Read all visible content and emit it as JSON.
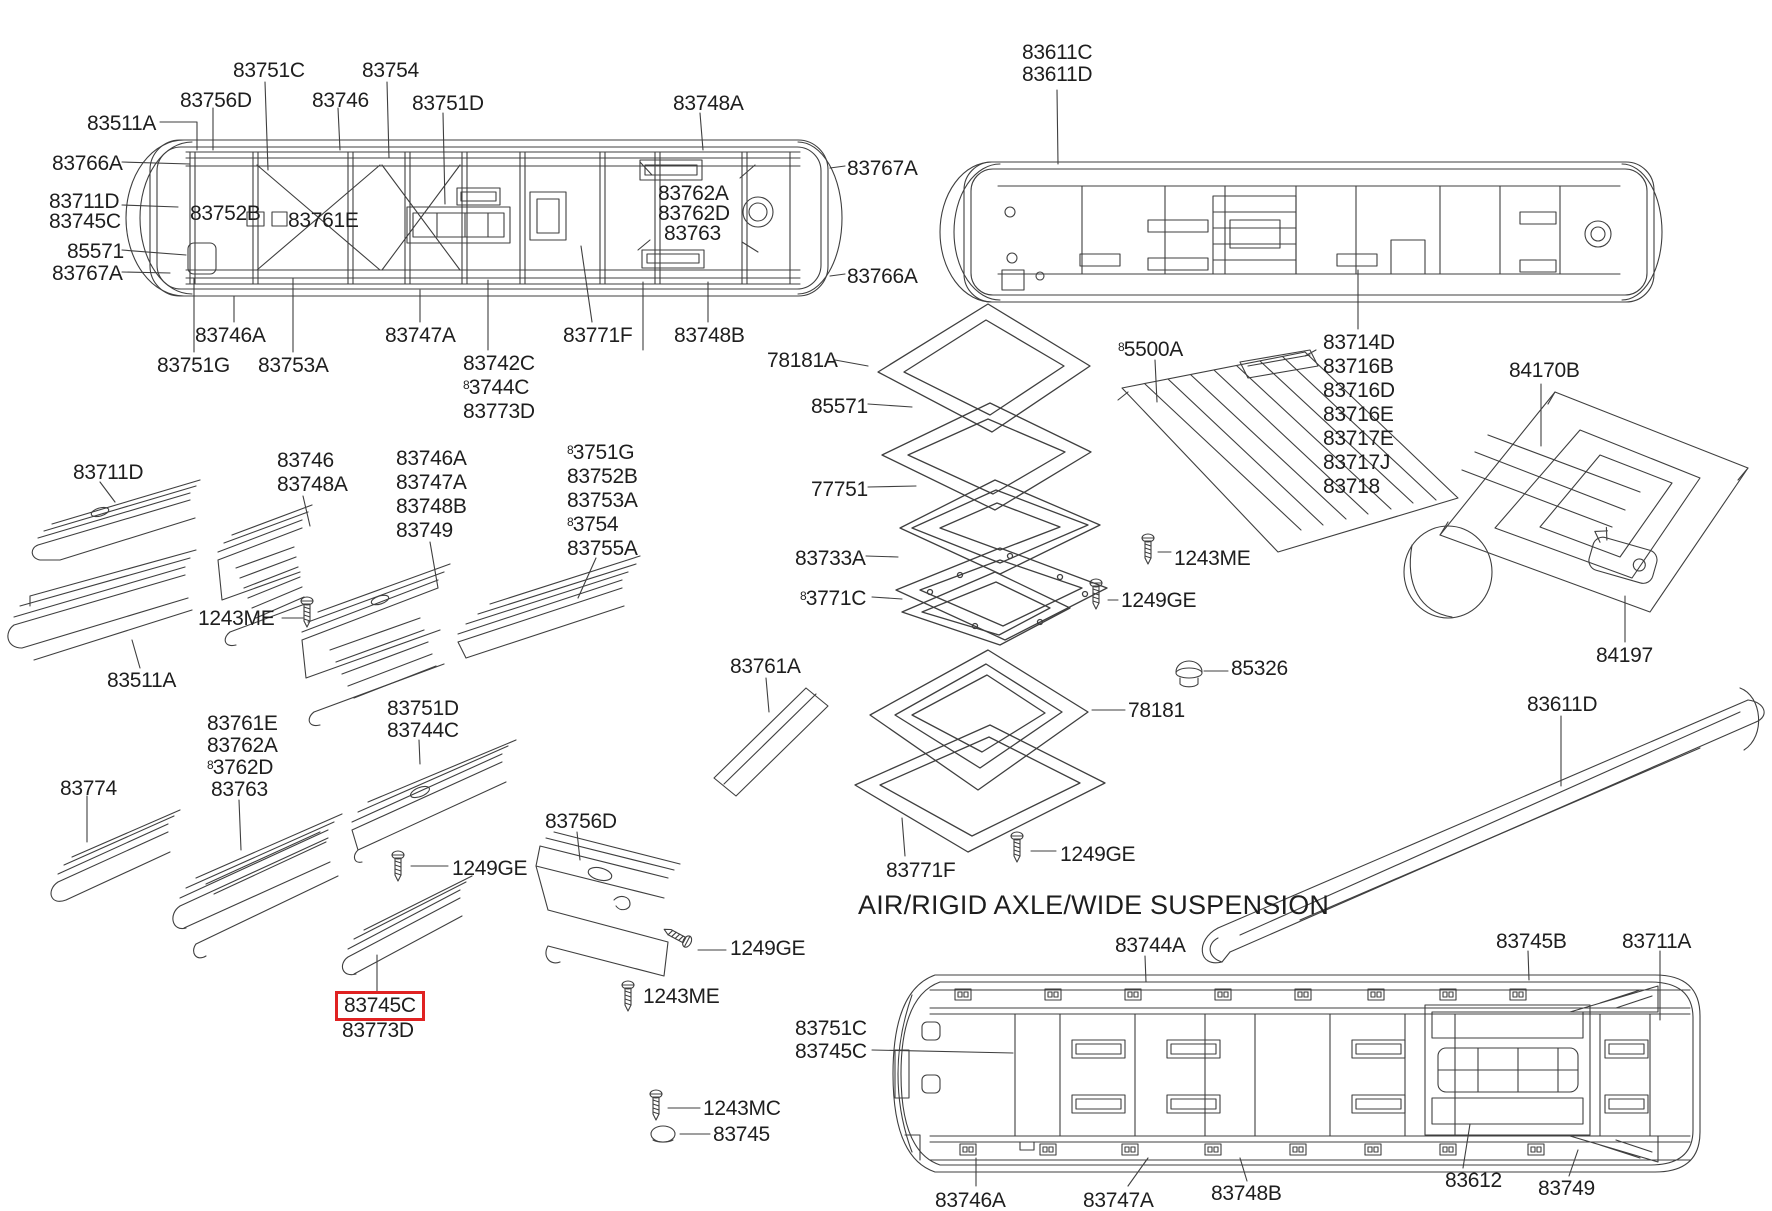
{
  "diagram": {
    "heading": "AIR/RIGID AXLE/WIDE SUSPENSION",
    "colors": {
      "background": "#ffffff",
      "line": "#3f3f3f",
      "text": "#1e1e1e",
      "highlight_box": "#e02222"
    },
    "icons": [
      "screw-icon",
      "grommet-icon",
      "cap-icon"
    ],
    "highlighted_part": "83745C",
    "labels": [
      {
        "text": "83751C",
        "x": 233,
        "y": 60
      },
      {
        "text": "83754",
        "x": 362,
        "y": 60
      },
      {
        "text": "83756D",
        "x": 180,
        "y": 90
      },
      {
        "text": "83746",
        "x": 312,
        "y": 90
      },
      {
        "text": "83751D",
        "x": 412,
        "y": 93
      },
      {
        "text": "83748A",
        "x": 673,
        "y": 93
      },
      {
        "text": "83511A",
        "x": 87,
        "y": 113
      },
      {
        "text": "83766A",
        "x": 52,
        "y": 153
      },
      {
        "text": "83767A",
        "x": 847,
        "y": 158
      },
      {
        "text": "83711D",
        "x": 49,
        "y": 191
      },
      {
        "text": "83745C",
        "x": 49,
        "y": 211
      },
      {
        "text": "83752B",
        "x": 190,
        "y": 203
      },
      {
        "text": "83761E",
        "x": 288,
        "y": 210
      },
      {
        "text": "83762A",
        "x": 658,
        "y": 183
      },
      {
        "text": "83762D",
        "x": 658,
        "y": 203
      },
      {
        "text": "83763",
        "x": 664,
        "y": 223
      },
      {
        "text": "85571",
        "x": 67,
        "y": 241
      },
      {
        "text": "83767A",
        "x": 52,
        "y": 263
      },
      {
        "text": "83766A",
        "x": 847,
        "y": 266
      },
      {
        "text": "83746A",
        "x": 195,
        "y": 325
      },
      {
        "text": "83747A",
        "x": 385,
        "y": 325
      },
      {
        "text": "83771F",
        "x": 563,
        "y": 325
      },
      {
        "text": "83748B",
        "x": 674,
        "y": 325
      },
      {
        "text": "83751G",
        "x": 157,
        "y": 355
      },
      {
        "text": "83753A",
        "x": 258,
        "y": 355
      },
      {
        "text": "83742C",
        "x": 463,
        "y": 353
      },
      {
        "text": "83744C",
        "x": 463,
        "y": 377,
        "odd8": true
      },
      {
        "text": "83773D",
        "x": 463,
        "y": 401
      },
      {
        "text": "78181A",
        "x": 767,
        "y": 350
      },
      {
        "text": "83611C",
        "x": 1022,
        "y": 42
      },
      {
        "text": "83611D",
        "x": 1022,
        "y": 64
      },
      {
        "text": "83714D",
        "x": 1323,
        "y": 332
      },
      {
        "text": "83716B",
        "x": 1323,
        "y": 356
      },
      {
        "text": "83716D",
        "x": 1323,
        "y": 380
      },
      {
        "text": "83716E",
        "x": 1323,
        "y": 404
      },
      {
        "text": "83717E",
        "x": 1323,
        "y": 428
      },
      {
        "text": "83717J",
        "x": 1323,
        "y": 452
      },
      {
        "text": "83718",
        "x": 1323,
        "y": 476
      },
      {
        "text": "84170B",
        "x": 1509,
        "y": 360
      },
      {
        "text": "84197",
        "x": 1596,
        "y": 645
      },
      {
        "text": "83611D",
        "x": 1527,
        "y": 694
      },
      {
        "text": "85571",
        "x": 811,
        "y": 396
      },
      {
        "text": "77751",
        "x": 811,
        "y": 479
      },
      {
        "text": "83733A",
        "x": 795,
        "y": 548
      },
      {
        "text": "83771C",
        "x": 800,
        "y": 588,
        "odd8": true
      },
      {
        "text": "85500A",
        "x": 1118,
        "y": 339,
        "odd8": true
      },
      {
        "text": "1243ME",
        "x": 1174,
        "y": 548
      },
      {
        "text": "1249GE",
        "x": 1121,
        "y": 590
      },
      {
        "text": "85326",
        "x": 1231,
        "y": 658
      },
      {
        "text": "78181",
        "x": 1128,
        "y": 700
      },
      {
        "text": "83761A",
        "x": 730,
        "y": 656
      },
      {
        "text": "83771F",
        "x": 886,
        "y": 860
      },
      {
        "text": "1249GE",
        "x": 1060,
        "y": 844
      },
      {
        "text": "83711D",
        "x": 73,
        "y": 462
      },
      {
        "text": "83746",
        "x": 277,
        "y": 450
      },
      {
        "text": "83748A",
        "x": 277,
        "y": 474
      },
      {
        "text": "83746A",
        "x": 396,
        "y": 448
      },
      {
        "text": "83747A",
        "x": 396,
        "y": 472
      },
      {
        "text": "83748B",
        "x": 396,
        "y": 496
      },
      {
        "text": "83749",
        "x": 396,
        "y": 520
      },
      {
        "text": "83751G",
        "x": 567,
        "y": 442,
        "odd8": true
      },
      {
        "text": "83752B",
        "x": 567,
        "y": 466
      },
      {
        "text": "83753A",
        "x": 567,
        "y": 490
      },
      {
        "text": "83754",
        "x": 567,
        "y": 514,
        "odd8": true
      },
      {
        "text": "83755A",
        "x": 567,
        "y": 538
      },
      {
        "text": "1243ME",
        "x": 198,
        "y": 608
      },
      {
        "text": "83511A",
        "x": 107,
        "y": 670
      },
      {
        "text": "83761E",
        "x": 207,
        "y": 713
      },
      {
        "text": "83762A",
        "x": 207,
        "y": 735
      },
      {
        "text": "83762D",
        "x": 207,
        "y": 757,
        "odd8": true
      },
      {
        "text": "83763",
        "x": 211,
        "y": 779
      },
      {
        "text": "83774",
        "x": 60,
        "y": 778
      },
      {
        "text": "83751D",
        "x": 387,
        "y": 698
      },
      {
        "text": "83744C",
        "x": 387,
        "y": 720
      },
      {
        "text": "1249GE",
        "x": 452,
        "y": 858
      },
      {
        "text": "83756D",
        "x": 545,
        "y": 811
      },
      {
        "text": "1249GE",
        "x": 730,
        "y": 938
      },
      {
        "text": "1243ME",
        "x": 643,
        "y": 986
      },
      {
        "text": "83745C",
        "x": 344,
        "y": 995,
        "box": true
      },
      {
        "text": "83773D",
        "x": 342,
        "y": 1020
      },
      {
        "text": "1243MC",
        "x": 703,
        "y": 1098
      },
      {
        "text": "83745",
        "x": 713,
        "y": 1124
      },
      {
        "text": "83744A",
        "x": 1115,
        "y": 935
      },
      {
        "text": "83745B",
        "x": 1496,
        "y": 931
      },
      {
        "text": "83711A",
        "x": 1622,
        "y": 931
      },
      {
        "text": "83751C",
        "x": 795,
        "y": 1018
      },
      {
        "text": "83745C",
        "x": 795,
        "y": 1041
      },
      {
        "text": "83746A",
        "x": 935,
        "y": 1190
      },
      {
        "text": "83747A",
        "x": 1083,
        "y": 1190
      },
      {
        "text": "83748B",
        "x": 1211,
        "y": 1183
      },
      {
        "text": "83612",
        "x": 1445,
        "y": 1170
      },
      {
        "text": "83749",
        "x": 1538,
        "y": 1178
      }
    ]
  }
}
